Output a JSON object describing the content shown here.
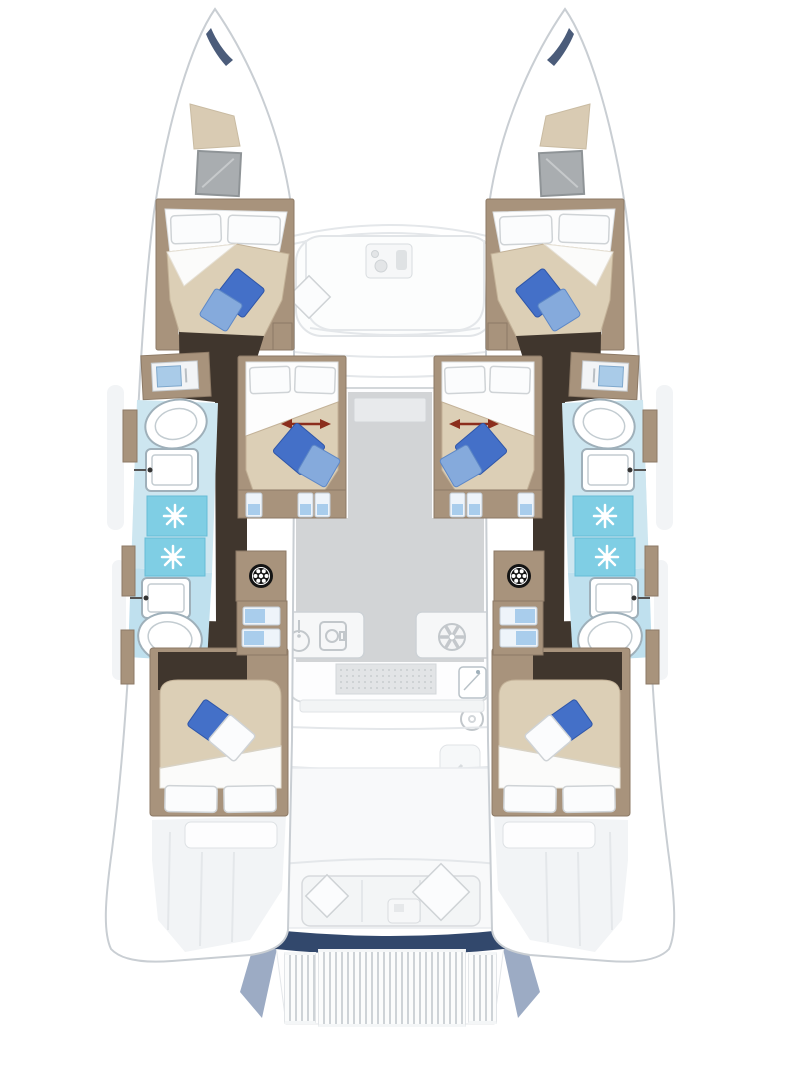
{
  "page": {
    "title": "Catamaran interior floor plan, top view, bow up",
    "diagram_type": "yacht-floor-plan"
  },
  "colors": {
    "outline": "#c9ced3",
    "deck-faint": "#f2f4f6",
    "wood": "#a8937c",
    "wood-dark": "#8d7a66",
    "floor-dark": "#40362d",
    "duvet": "#dccfb6",
    "duvet-edge": "#c3b298",
    "pillow-blue": "#4470c8",
    "pillow-blue-light": "#85aadc",
    "bath-floor": "#cde6f0",
    "bath-floor-deep": "#bfe0ee",
    "shower": "#7fcee4",
    "salon-floor": "#d2d4d6",
    "counter": "#f6f7f8",
    "icon-gray": "#c2c7cb",
    "tread-blue": "#a9cdec",
    "navy": "#32486c",
    "navy-shade": "#8396b5",
    "arrow-red": "#8b2e1d",
    "hatch-gray": "#a9adb0",
    "hatch-beige": "#d9cbb3",
    "washer-black": "#141414"
  },
  "icons": {
    "shower-drain-icon": "white 8-spoke starburst on aqua tile",
    "washing-machine-icon": "black drum circle with white dots",
    "stove-burner-icon": "gray 6-spoke fan circle",
    "galley-sink-icon": "circle with faucet stem",
    "toilet-icon": "white oval bowl outline",
    "wash-basin-icon": "white rounded rectangle basin with faucet dot",
    "berth-slide-arrow-icon": "dark red double-headed horizontal arrow",
    "bow-hatch-icon": "gray square deck hatch",
    "sail-locker-hatch-icon": "beige trapezoid hatch",
    "cushion-icon": "diamond rotated square cushion"
  },
  "layout_facts": {
    "hulls": 2,
    "double_berths": 6,
    "toilets": 4,
    "wash_basins": 4,
    "shower_stalls": 2,
    "shower_tiles_per_stall": 2,
    "berth_slide_arrows": 2,
    "companionway_stairs_per_hull": 1,
    "swim_platform_grating_segments": 3
  }
}
